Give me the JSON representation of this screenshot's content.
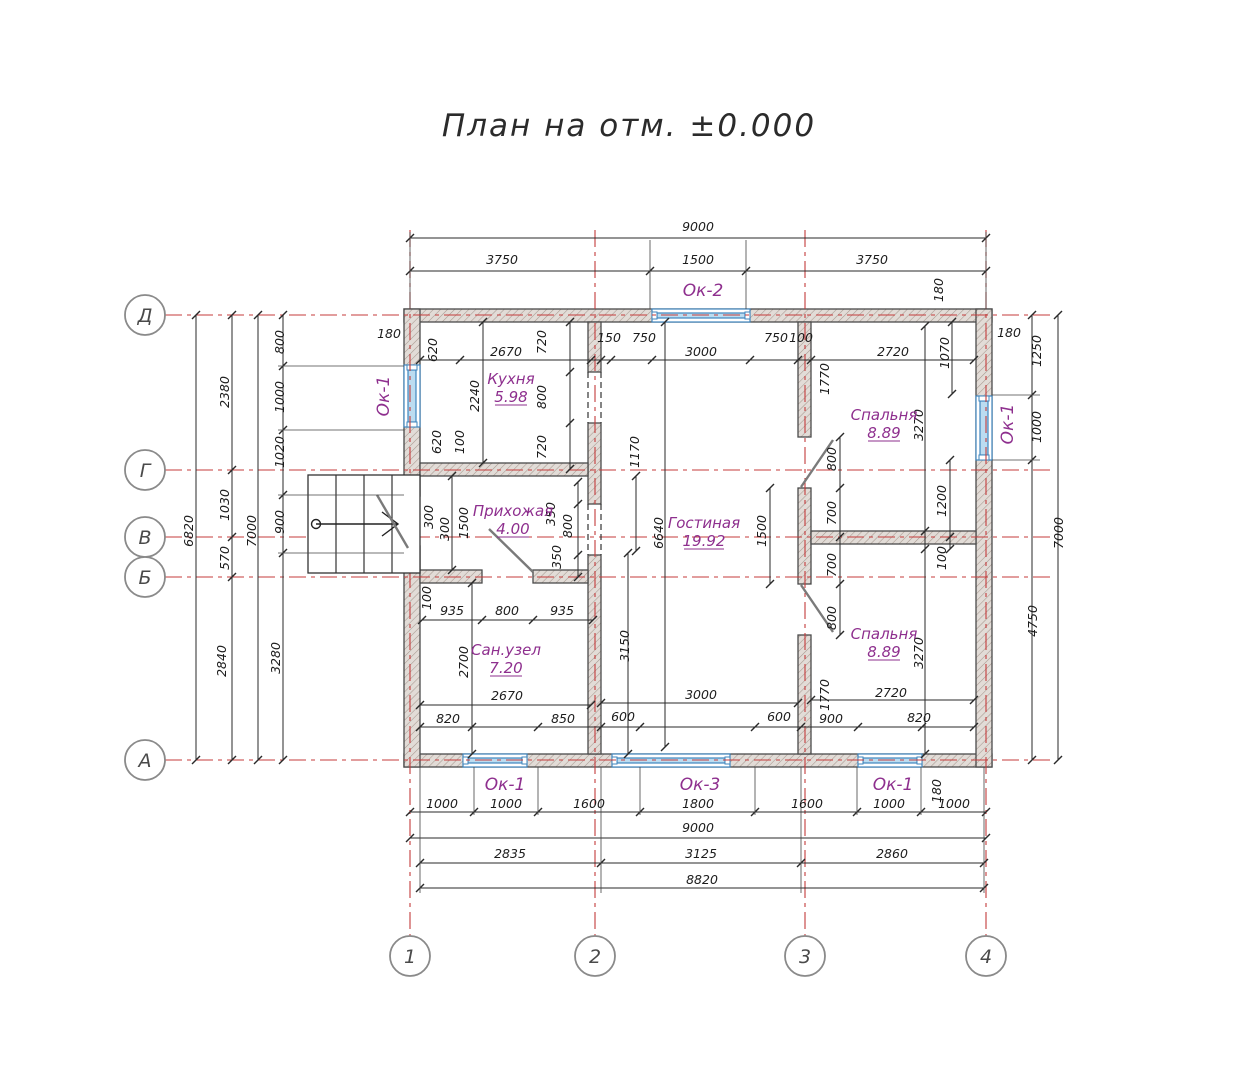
{
  "title": "План на отм. ±0.000",
  "colors": {
    "axis_red": "#c43b3b",
    "wall_hatch": "#a6988f",
    "wall_fill": "#e2dcd7",
    "wall_edge": "#4a4a4a",
    "window_blue": "#3f85bd",
    "window_fill": "#bcdcf0",
    "label_purple": "#8e2f8e",
    "dim_black": "#1c1c1c",
    "door_gray": "#7a7a7a"
  },
  "axes": {
    "horizontal": [
      {
        "label": "Д",
        "y": 315
      },
      {
        "label": "Г",
        "y": 470
      },
      {
        "label": "В",
        "y": 537
      },
      {
        "label": "Б",
        "y": 577
      },
      {
        "label": "А",
        "y": 760
      }
    ],
    "vertical": [
      {
        "label": "1",
        "x": 410
      },
      {
        "label": "2",
        "x": 595
      },
      {
        "label": "3",
        "x": 805
      },
      {
        "label": "4",
        "x": 986
      }
    ]
  },
  "rooms": [
    {
      "name": "Кухня",
      "area": "5.98",
      "x": 511,
      "y": 384
    },
    {
      "name": "Прихожая",
      "area": "4.00",
      "x": 513,
      "y": 516
    },
    {
      "name": "Гостиная",
      "area": "19.92",
      "x": 704,
      "y": 528
    },
    {
      "name": "Спальня",
      "area": "8.89",
      "x": 884,
      "y": 420
    },
    {
      "name": "Спальня",
      "area": "8.89",
      "x": 884,
      "y": 639
    },
    {
      "name": "Сан.узел",
      "area": "7.20",
      "x": 506,
      "y": 655
    }
  ],
  "window_labels": [
    {
      "t": "Ок-2",
      "x": 703,
      "y": 296,
      "r": 0
    },
    {
      "t": "Ок-1",
      "x": 389,
      "y": 396,
      "r": 1
    },
    {
      "t": "Ок-1",
      "x": 1013,
      "y": 424,
      "r": 1
    },
    {
      "t": "Ок-1",
      "x": 505,
      "y": 790,
      "r": 0
    },
    {
      "t": "Ок-3",
      "x": 700,
      "y": 790,
      "r": 0
    },
    {
      "t": "Ок-1",
      "x": 893,
      "y": 790,
      "r": 0
    }
  ],
  "dimensions": [
    {
      "t": "9000",
      "x": 698,
      "y": 231,
      "r": 0
    },
    {
      "t": "3750",
      "x": 502,
      "y": 264,
      "r": 0
    },
    {
      "t": "1500",
      "x": 698,
      "y": 264,
      "r": 0
    },
    {
      "t": "3750",
      "x": 872,
      "y": 264,
      "r": 0
    },
    {
      "t": "180",
      "x": 943,
      "y": 290,
      "r": 1
    },
    {
      "t": "180",
      "x": 389,
      "y": 338,
      "r": 0
    },
    {
      "t": "620",
      "x": 437,
      "y": 350,
      "r": 1
    },
    {
      "t": "2670",
      "x": 506,
      "y": 356,
      "r": 0
    },
    {
      "t": "150",
      "x": 609,
      "y": 342,
      "r": 0
    },
    {
      "t": "750",
      "x": 644,
      "y": 342,
      "r": 0
    },
    {
      "t": "3000",
      "x": 701,
      "y": 356,
      "r": 0
    },
    {
      "t": "750",
      "x": 776,
      "y": 342,
      "r": 0
    },
    {
      "t": "100",
      "x": 801,
      "y": 342,
      "r": 0
    },
    {
      "t": "2720",
      "x": 893,
      "y": 356,
      "r": 0
    },
    {
      "t": "1070",
      "x": 949,
      "y": 353,
      "r": 1
    },
    {
      "t": "2240",
      "x": 479,
      "y": 396,
      "r": 1
    },
    {
      "t": "720",
      "x": 546,
      "y": 342,
      "r": 1
    },
    {
      "t": "800",
      "x": 546,
      "y": 397,
      "r": 1
    },
    {
      "t": "720",
      "x": 546,
      "y": 447,
      "r": 1
    },
    {
      "t": "620",
      "x": 441,
      "y": 442,
      "r": 1
    },
    {
      "t": "100",
      "x": 464,
      "y": 442,
      "r": 1
    },
    {
      "t": "1170",
      "x": 639,
      "y": 452,
      "r": 1
    },
    {
      "t": "6820",
      "x": 193,
      "y": 531,
      "r": 1
    },
    {
      "t": "2380",
      "x": 229,
      "y": 392,
      "r": 1
    },
    {
      "t": "1030",
      "x": 229,
      "y": 505,
      "r": 1
    },
    {
      "t": "570",
      "x": 229,
      "y": 558,
      "r": 1
    },
    {
      "t": "2840",
      "x": 226,
      "y": 661,
      "r": 1
    },
    {
      "t": "7000",
      "x": 256,
      "y": 531,
      "r": 1
    },
    {
      "t": "800",
      "x": 284,
      "y": 342,
      "r": 1
    },
    {
      "t": "1000",
      "x": 284,
      "y": 397,
      "r": 1
    },
    {
      "t": "1020",
      "x": 284,
      "y": 452,
      "r": 1
    },
    {
      "t": "900",
      "x": 284,
      "y": 522,
      "r": 1
    },
    {
      "t": "3280",
      "x": 280,
      "y": 658,
      "r": 1
    },
    {
      "t": "300",
      "x": 433,
      "y": 517,
      "r": 1
    },
    {
      "t": "300",
      "x": 449,
      "y": 529,
      "r": 1
    },
    {
      "t": "1500",
      "x": 468,
      "y": 523,
      "r": 1
    },
    {
      "t": "350",
      "x": 555,
      "y": 514,
      "r": 1
    },
    {
      "t": "800",
      "x": 572,
      "y": 526,
      "r": 1
    },
    {
      "t": "350",
      "x": 561,
      "y": 557,
      "r": 1
    },
    {
      "t": "6640",
      "x": 663,
      "y": 533,
      "r": 1
    },
    {
      "t": "1500",
      "x": 766,
      "y": 531,
      "r": 1
    },
    {
      "t": "800",
      "x": 836,
      "y": 459,
      "r": 1
    },
    {
      "t": "700",
      "x": 836,
      "y": 513,
      "r": 1
    },
    {
      "t": "700",
      "x": 836,
      "y": 565,
      "r": 1
    },
    {
      "t": "800",
      "x": 836,
      "y": 618,
      "r": 1
    },
    {
      "t": "3150",
      "x": 629,
      "y": 646,
      "r": 1
    },
    {
      "t": "3000",
      "x": 701,
      "y": 699,
      "r": 0
    },
    {
      "t": "600",
      "x": 623,
      "y": 721,
      "r": 0
    },
    {
      "t": "600",
      "x": 779,
      "y": 721,
      "r": 0
    },
    {
      "t": "900",
      "x": 831,
      "y": 723,
      "r": 0
    },
    {
      "t": "1770",
      "x": 829,
      "y": 695,
      "r": 1
    },
    {
      "t": "1770",
      "x": 829,
      "y": 379,
      "r": 1
    },
    {
      "t": "3270",
      "x": 923,
      "y": 425,
      "r": 1
    },
    {
      "t": "1200",
      "x": 946,
      "y": 501,
      "r": 1
    },
    {
      "t": "100",
      "x": 946,
      "y": 558,
      "r": 1
    },
    {
      "t": "3270",
      "x": 923,
      "y": 653,
      "r": 1
    },
    {
      "t": "2720",
      "x": 891,
      "y": 697,
      "r": 0
    },
    {
      "t": "820",
      "x": 919,
      "y": 722,
      "r": 0
    },
    {
      "t": "4750",
      "x": 1037,
      "y": 621,
      "r": 1
    },
    {
      "t": "100",
      "x": 431,
      "y": 598,
      "r": 1
    },
    {
      "t": "935",
      "x": 452,
      "y": 615,
      "r": 0
    },
    {
      "t": "800",
      "x": 507,
      "y": 615,
      "r": 0
    },
    {
      "t": "935",
      "x": 562,
      "y": 615,
      "r": 0
    },
    {
      "t": "2700",
      "x": 468,
      "y": 662,
      "r": 1
    },
    {
      "t": "2670",
      "x": 507,
      "y": 700,
      "r": 0
    },
    {
      "t": "820",
      "x": 448,
      "y": 723,
      "r": 0
    },
    {
      "t": "850",
      "x": 563,
      "y": 723,
      "r": 0
    },
    {
      "t": "180",
      "x": 941,
      "y": 791,
      "r": 1
    },
    {
      "t": "1000",
      "x": 442,
      "y": 808,
      "r": 0
    },
    {
      "t": "1000",
      "x": 506,
      "y": 808,
      "r": 0
    },
    {
      "t": "1600",
      "x": 589,
      "y": 808,
      "r": 0
    },
    {
      "t": "1800",
      "x": 698,
      "y": 808,
      "r": 0
    },
    {
      "t": "1600",
      "x": 807,
      "y": 808,
      "r": 0
    },
    {
      "t": "1000",
      "x": 889,
      "y": 808,
      "r": 0
    },
    {
      "t": "1000",
      "x": 954,
      "y": 808,
      "r": 0
    },
    {
      "t": "9000",
      "x": 698,
      "y": 832,
      "r": 0
    },
    {
      "t": "2835",
      "x": 510,
      "y": 858,
      "r": 0
    },
    {
      "t": "3125",
      "x": 701,
      "y": 858,
      "r": 0
    },
    {
      "t": "2860",
      "x": 892,
      "y": 858,
      "r": 0
    },
    {
      "t": "8820",
      "x": 702,
      "y": 884,
      "r": 0
    },
    {
      "t": "180",
      "x": 1009,
      "y": 337,
      "r": 0
    },
    {
      "t": "1250",
      "x": 1041,
      "y": 351,
      "r": 1
    },
    {
      "t": "1000",
      "x": 1041,
      "y": 427,
      "r": 1
    },
    {
      "t": "7000",
      "x": 1063,
      "y": 533,
      "r": 1
    }
  ]
}
